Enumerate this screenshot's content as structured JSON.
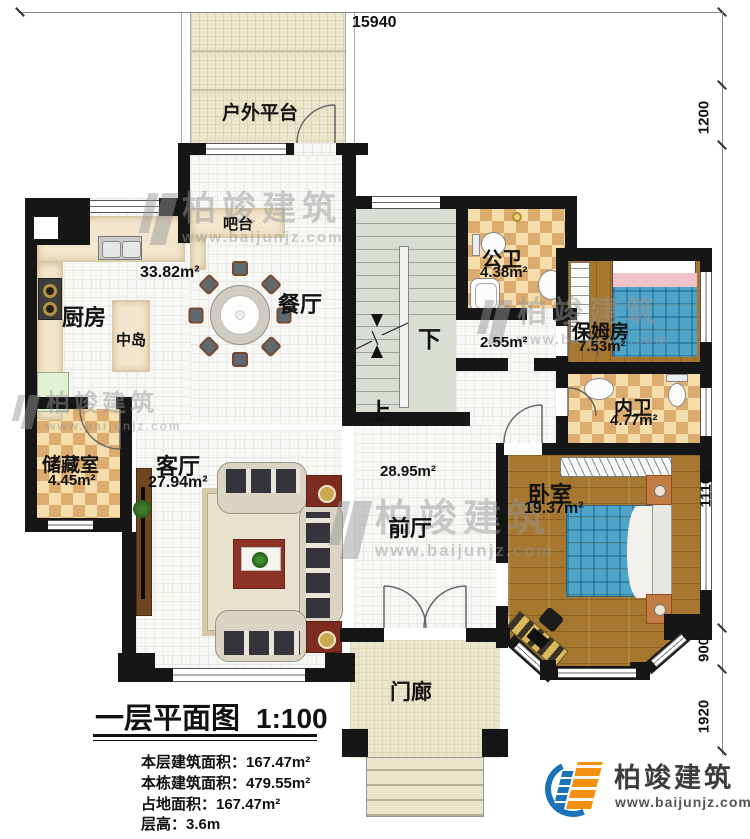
{
  "dimensions": {
    "top": "15940",
    "right": [
      "1200",
      "11100",
      "900",
      "1920"
    ]
  },
  "rooms": {
    "platform": "户外平台",
    "bar": "吧台",
    "kitchen": "厨房",
    "island": "中岛",
    "dining": "餐厅",
    "dining_area": "33.82m²",
    "public_bath": "公卫",
    "public_bath_area": "4.38m²",
    "corridor_area": "2.55m²",
    "nanny": "保姆房",
    "nanny_area": "7.53m²",
    "inner_bath": "内卫",
    "inner_bath_area": "4.77m²",
    "storage": "储藏室",
    "storage_area": "4.45m²",
    "living": "客厅",
    "living_area": "27.94m²",
    "foyer": "前厅",
    "foyer_area": "28.95m²",
    "bedroom": "卧室",
    "bedroom_area": "19.37m²",
    "porch": "门廊",
    "stair_down": "下",
    "stair_up": "上"
  },
  "titleblock": {
    "title": "一层平面图",
    "scale": "1:100",
    "lines": [
      "本层建筑面积：167.47m²",
      "本栋建筑面积：479.55m²",
      "占地面积：167.47m²",
      "层高：3.6m"
    ]
  },
  "brand": {
    "name": "柏竣建筑",
    "url": "www.baijunjz.com"
  },
  "watermark": {
    "name": "柏竣建筑",
    "url": "www.baijunjz.com"
  }
}
